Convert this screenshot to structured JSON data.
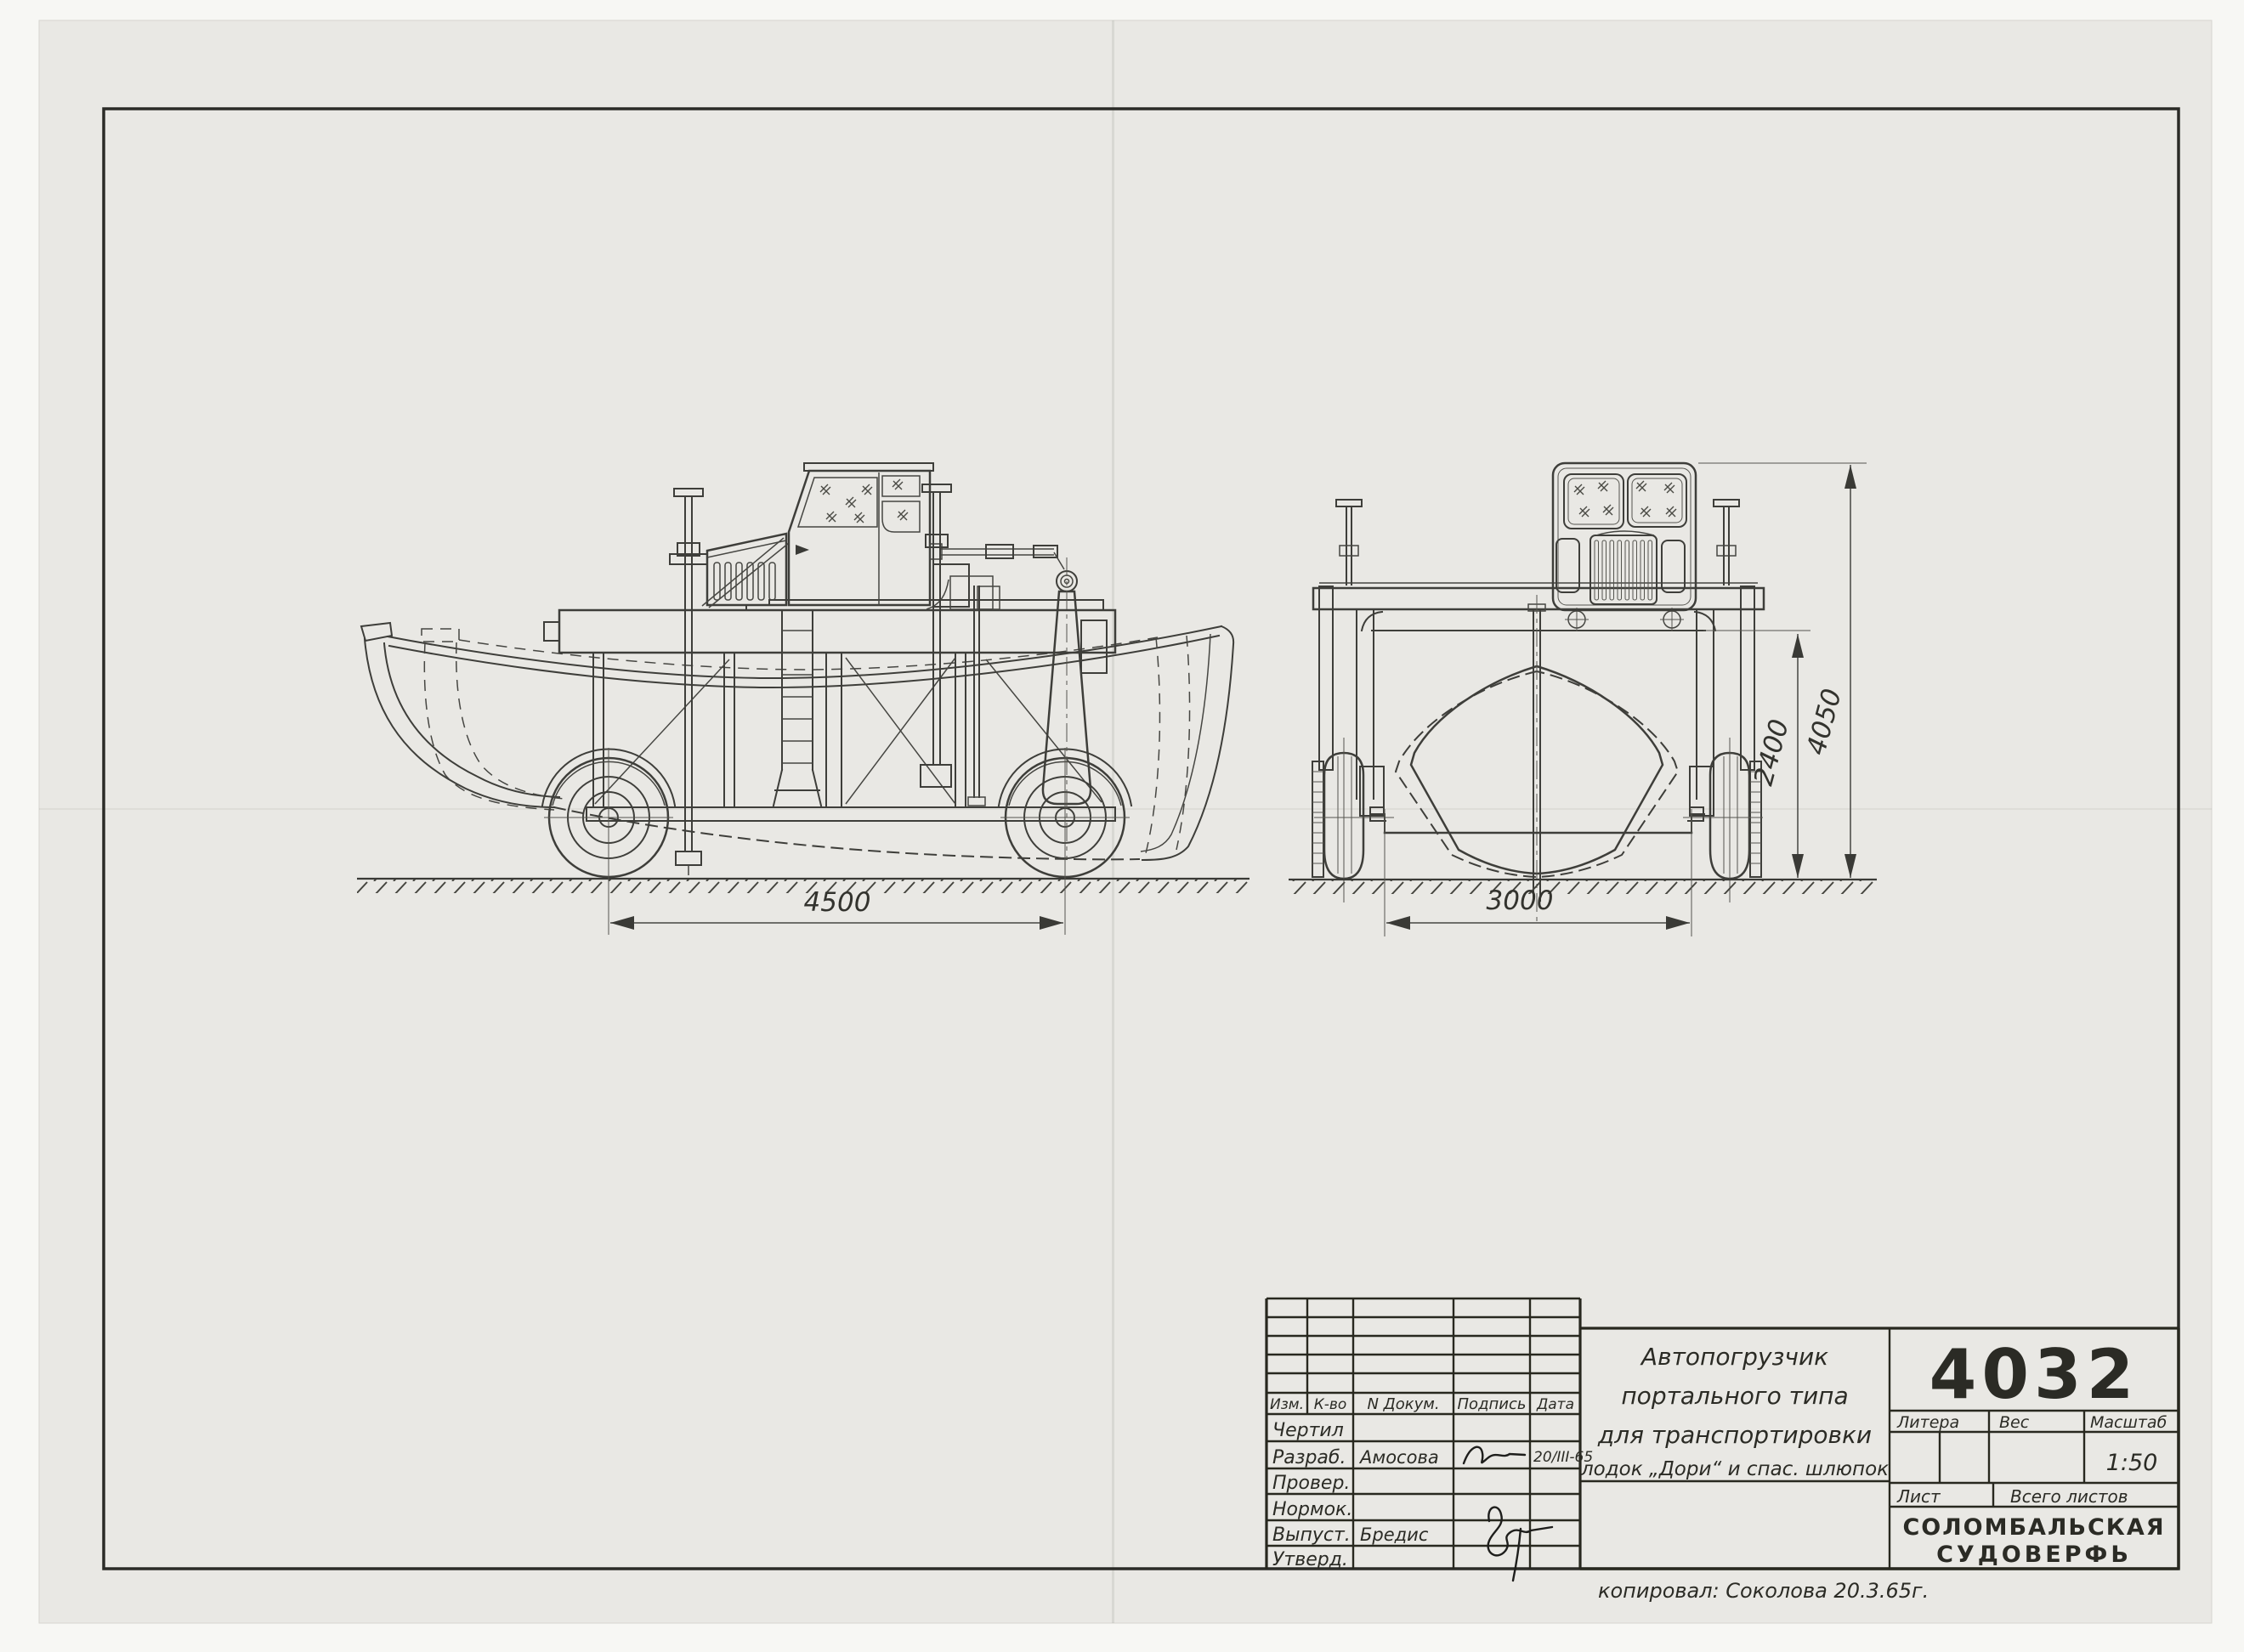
{
  "dimensions": {
    "wheelbase": "4500",
    "track": "3000",
    "clearance_height": "2400",
    "overall_height": "4050"
  },
  "title_block": {
    "doc_number": "4032",
    "title_line1": "Автопогрузчик",
    "title_line2": "портального типа",
    "title_line3": "для транспортировки",
    "title_line4": "лодок „Дори“ и спас. шлюпок",
    "labels": {
      "litera": "Литера",
      "ves": "Вес",
      "masshtab": "Масштаб",
      "list": "Лист",
      "vsego_listov": "Всего листов"
    },
    "scale": "1:50",
    "company_line1": "СОЛОМБАЛЬСКАЯ",
    "company_line2": "СУДОВЕРФЬ",
    "table": {
      "col_izm": "Изм.",
      "col_kvo": "К-во",
      "col_dokum": "N Докум.",
      "col_podpis": "Подпись",
      "col_data": "Дата",
      "row1_label": "Чертил",
      "row2_label": "Разраб.",
      "row2_name": "Амосова",
      "row2_date": "20/III-65",
      "row3_label": "Провер.",
      "row4_label": "Нормок.",
      "row5_label": "Выпуст.",
      "row5_name": "Бредис",
      "row6_label": "Утверд."
    },
    "copied_note": "копировал: Соколова    20.3.65г."
  }
}
